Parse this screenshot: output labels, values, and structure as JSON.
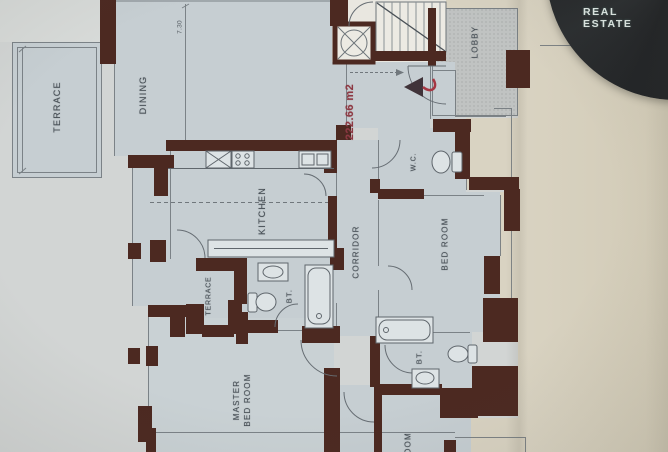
{
  "watermark": {
    "label": "REAL ESTATE"
  },
  "plan": {
    "area_label": "222.66 m2",
    "rooms": {
      "terrace": "TERRACE",
      "dining": "DINING",
      "kitchen": "KITCHEN",
      "corridor": "CORRIDOR",
      "lobby": "LOBBY",
      "wc": "W.C.",
      "bedroom": "BED ROOM",
      "terrace_small": "TERRACE",
      "bath1": "BT.",
      "master_line1": "MASTER",
      "master_line2": "BED ROOM",
      "bath2": "BT.",
      "room_partial": "ROOM"
    },
    "dimensions": {
      "top": "7.30"
    }
  },
  "colors": {
    "wall": "#4c2921",
    "room": "#c6ced2",
    "lobby": "#c0c3c2",
    "paper-left": "#d2d5d4",
    "paper-right": "#d9d3c2",
    "line": "#6e757a",
    "label": "#454d54",
    "red": "#8d3943",
    "logo-bg": "#232527",
    "logo-text": "#dfe8e4"
  }
}
